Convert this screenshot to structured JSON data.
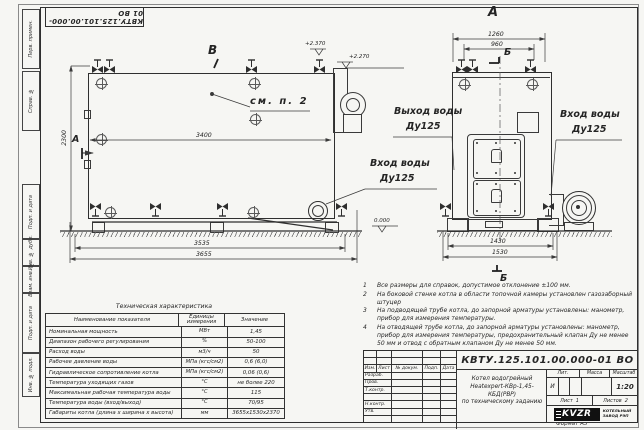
{
  "sheet": {
    "top_stamp": "КВТУ.125.101.00.000-01 ВО",
    "format_label": "Формат А3",
    "margins": [
      "Перв. примен.",
      "Справ. №",
      "Подп. и дата",
      "Инв. № дубл.",
      "Взам. инв. №",
      "Подп. и дата",
      "Инв. № подл."
    ]
  },
  "left_view": {
    "view_label": "В",
    "section_arrow_label": "А",
    "callout": "см. п. 2",
    "dim_width": "3400",
    "dim_height": "2300",
    "dim_base": "3535",
    "dim_overall": "3655",
    "elev_top": "+2.370",
    "elev_mid": "+2.270",
    "elev_zero": "0.000",
    "inlet_line1": "Вход воды",
    "inlet_line2": "Ду125"
  },
  "front_view": {
    "view_label": "А",
    "section_label": "Б",
    "dim_top": "1260",
    "dim_top2": "960",
    "dim_base": "1430",
    "dim_overall": "1530",
    "outlet_line1": "Выход воды",
    "outlet_line2": "Ду125",
    "inlet_line1": "Вход воды",
    "inlet_line2": "Ду125"
  },
  "tech_table": {
    "title": "Техническая характеристика",
    "headers": [
      "Наименование показателя",
      "Единицы измерения",
      "Значение"
    ],
    "rows": [
      {
        "name": "Номинальная мощность",
        "unit": "МВт",
        "value": "1,45"
      },
      {
        "name": "Диапазон рабочего регулирования",
        "unit": "%",
        "value": "50-100"
      },
      {
        "name": "Расход воды",
        "unit": "м3/ч",
        "value": "50"
      },
      {
        "name": "Рабочее давление воды",
        "unit": "МПа (кгс/см2)",
        "value": "0,6 (6,0)"
      },
      {
        "name": "Гидравлическое сопротивление котла",
        "unit": "МПа (кгс/см2)",
        "value": "0,06 (0,6)"
      },
      {
        "name": "Температура уходящих газов",
        "unit": "°С",
        "value": "не более 220"
      },
      {
        "name": "Максимальная рабочая температура воды",
        "unit": "°С",
        "value": "115"
      },
      {
        "name": "Температура воды (вход/выход)",
        "unit": "°С",
        "value": "70/95"
      },
      {
        "name": "Габариты котла (длина х ширина х высота)",
        "unit": "мм",
        "value": "3655х1530х2370"
      }
    ]
  },
  "notes": [
    {
      "num": "1",
      "text": "Все размеры для справок, допустимое отклонение ±100 мм."
    },
    {
      "num": "2",
      "text": "На боковой стенке котла в области топочной камеры установлен газозаборный штуцер"
    },
    {
      "num": "3",
      "text": "На подводящей трубе котла, до запорной арматуры установлены: манометр, прибор для измерения температуры."
    },
    {
      "num": "4",
      "text": "На отводящей трубе котла, до запорной арматуры установлены: манометр, прибор для измерения температуры, предохранительный клапан Ду не менее 50 мм и отвод с обратным клапаном Ду не менее 50 мм."
    }
  ],
  "title_block": {
    "doc_number": "КВТУ.125.101.00.000-01 ВО",
    "name_lines": [
      "Котел водогрейный",
      "Heatexpert-КВр-1,45-КБД(РВР)",
      "по техническому заданию"
    ],
    "header_cols": [
      "Изм.",
      "Лист",
      "№ докум.",
      "Подп.",
      "Дата"
    ],
    "sig_rows": [
      "Разраб.",
      "Пров.",
      "Т.контр.",
      "Н.контр.",
      "Утв."
    ],
    "lit_header": [
      "Лит.",
      "Масса",
      "Масштаб"
    ],
    "lit_value": "И",
    "scale": "1:20",
    "sheet_label": "Лист",
    "sheet_num": "1",
    "sheets_label": "Листов",
    "sheets_num": "2",
    "company_logo": "KVZR",
    "company_name": [
      "КОТЕЛЬНЫЙ",
      "ЗАВОД РЭП"
    ]
  }
}
